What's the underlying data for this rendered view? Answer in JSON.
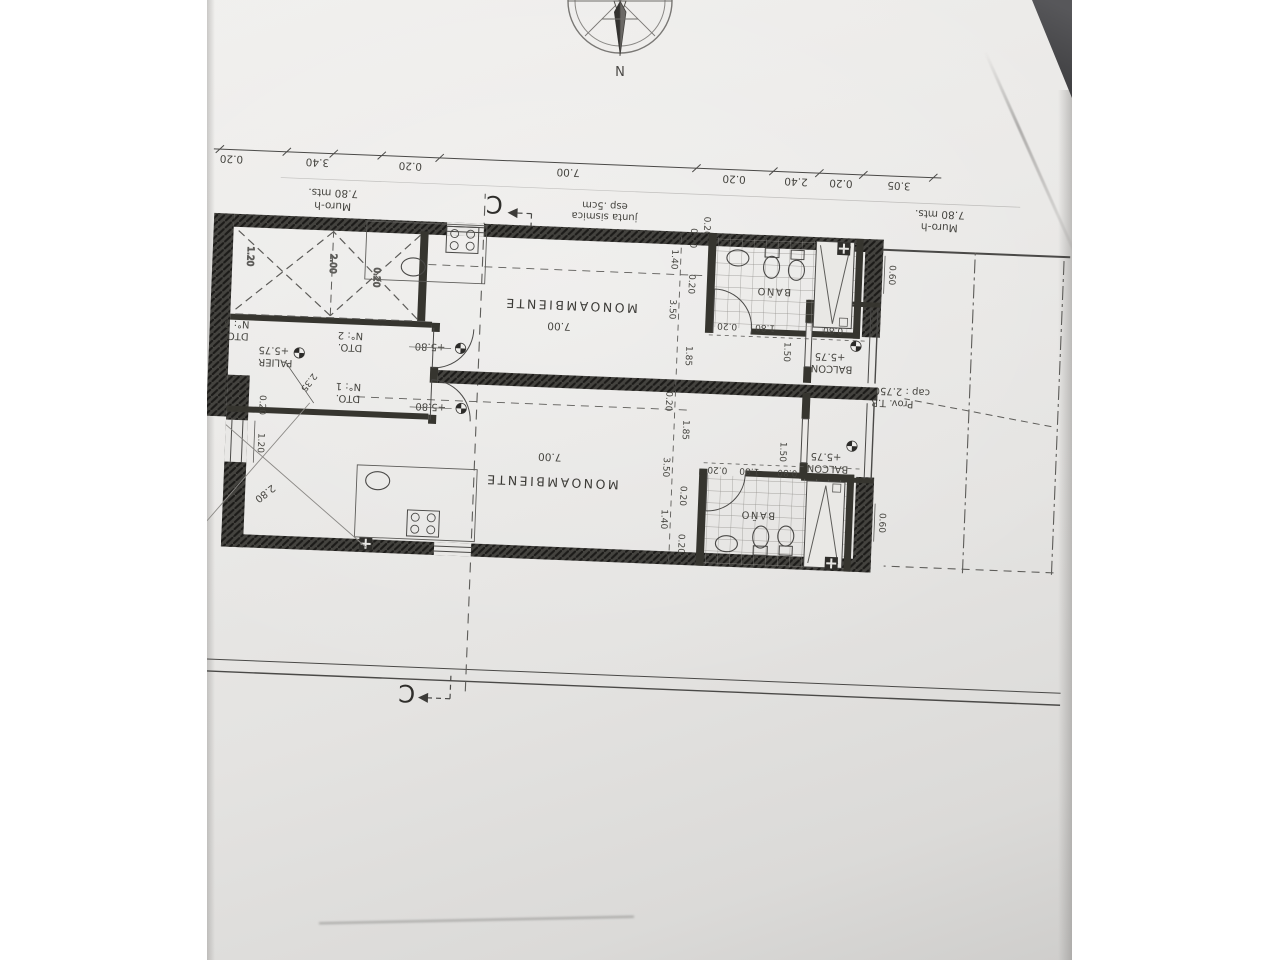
{
  "compass": {
    "north": "N"
  },
  "sections": {
    "top": "C",
    "bottom": "C"
  },
  "top_dims": [
    "3.05",
    "0.20",
    "2.40",
    "0.20",
    "7.00",
    "0.20",
    "3.40",
    "0.20"
  ],
  "murals": {
    "left_l1": "Muro-h",
    "left_l2": "7.80 mts.",
    "right_l1": "Muro-h",
    "right_l2": "7.80 mts."
  },
  "joint": {
    "l1": "junta sismica",
    "l2": "esp .5cm",
    "wall_dim": "0.20"
  },
  "tank": {
    "l1": "Prov. T.R",
    "l2": "cap : 2.750 lts."
  },
  "unit_a": {
    "room": "MONOAMBIENTE",
    "room_dim": "7.00",
    "room_level": "+5.80",
    "bath": "BAÑO",
    "balcony": "BALCON",
    "balcony_level": "+5.75",
    "balcony_door_dim": "1.50",
    "edge_dim": "0.60",
    "col_dims": [
      "0.20",
      "1.40",
      "0.20",
      "3.50",
      "1.85",
      "0.20"
    ],
    "row_dims": [
      "0.80",
      "1.80",
      "0.20"
    ]
  },
  "unit_b": {
    "room": "MONOAMBIENTE",
    "room_dim": "7.00",
    "room_level": "+5.80",
    "bath": "BAÑO",
    "balcony": "BALCON",
    "balcony_level": "+5.75",
    "balcony_door_dim": "1.50",
    "edge_dim": "0.60",
    "col_dims": [
      "1.85",
      "3.50",
      "0.20",
      "1.40",
      "0.20"
    ],
    "row_dims": [
      "0.80",
      "1.80",
      "0.20"
    ]
  },
  "hall": {
    "name": "PALIER",
    "level": "+5.75",
    "dim": "2.35",
    "apt1_l1": "DTO.",
    "apt1_l2": "N°: 1",
    "apt2_l1": "DTO.",
    "apt2_l2": "N°: 2",
    "apt3_l1": "DTO.",
    "apt3_l2": "N°: 3"
  },
  "stairs": {
    "dims": [
      "2.00",
      "1.20",
      "0.20"
    ]
  },
  "side": {
    "wall_dim": "0.20",
    "window_dim": "1.20",
    "diag_dim": "2.80"
  }
}
